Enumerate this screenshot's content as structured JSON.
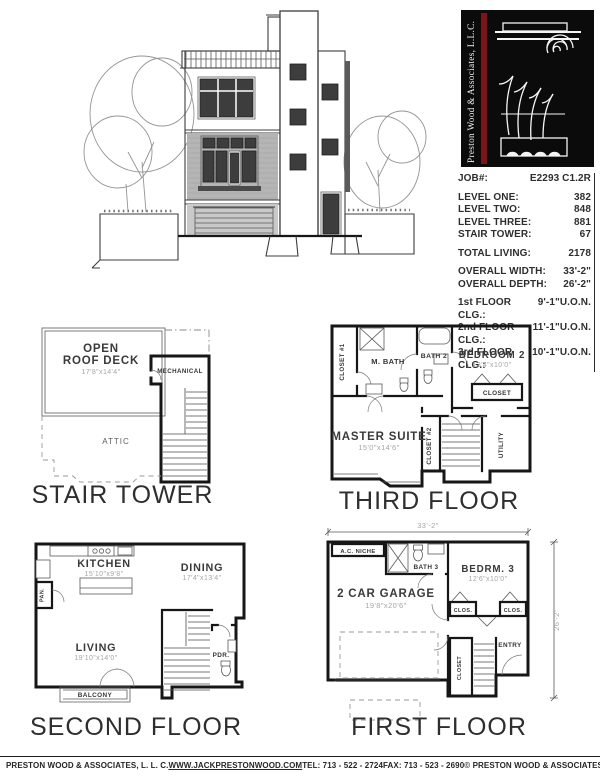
{
  "colors": {
    "line": "#161616",
    "logo_bg": "#0b0b0b",
    "logo_stripe": "#7d1418",
    "dim_text": "#a6a6a6"
  },
  "logo": {
    "vertical_text": "Preston Wood & Associates, L.L.C."
  },
  "info": {
    "job": {
      "label": "JOB#:",
      "value": "E2293 C1.2R"
    },
    "levels": [
      {
        "label": "LEVEL ONE:",
        "value": "382"
      },
      {
        "label": "LEVEL TWO:",
        "value": "848"
      },
      {
        "label": "LEVEL THREE:",
        "value": "881"
      },
      {
        "label": "STAIR TOWER:",
        "value": "67"
      }
    ],
    "total": {
      "label": "TOTAL LIVING:",
      "value": "2178"
    },
    "overall": [
      {
        "label": "OVERALL WIDTH:",
        "value": "33'-2\""
      },
      {
        "label": "OVERALL DEPTH:",
        "value": "26'-2\""
      }
    ],
    "ceilings": [
      {
        "label": "1st FLOOR CLG.:",
        "value": "9'-1\"U.O.N."
      },
      {
        "label": "2nd FLOOR CLG.:",
        "value": "11'-1\"U.O.N."
      },
      {
        "label": "3rd FLOOR CLG.:",
        "value": "10'-1\"U.O.N."
      }
    ]
  },
  "plans": {
    "stair_tower": {
      "title": "STAIR TOWER",
      "open_line1": "OPEN",
      "open_line2": "ROOF DECK",
      "open_dim": "17'8\"x14'4\"",
      "mechanical": "MECHANICAL",
      "attic": "ATTIC"
    },
    "third_floor": {
      "title": "THIRD FLOOR",
      "closet1": "CLOSET #1",
      "mbath": "M. BATH",
      "bath2": "BATH 2",
      "bedroom2": "BEDROOM 2",
      "bedroom2_dim": "13'4\"x10'0\"",
      "closet": "CLOSET",
      "master": "MASTER SUITE",
      "master_dim": "15'0\"x14'6\"",
      "closet2": "CLOSET #2",
      "utility": "UTILITY"
    },
    "second_floor": {
      "title": "SECOND FLOOR",
      "kitchen": "KITCHEN",
      "kitchen_dim": "15'10\"x9'8\"",
      "dining": "DINING",
      "dining_dim": "17'4\"x13'4\"",
      "living": "LIVING",
      "living_dim": "19'10\"x14'0\"",
      "pan": "PAN.",
      "pdr": "PDR.",
      "balcony": "BALCONY"
    },
    "first_floor": {
      "title": "FIRST FLOOR",
      "width_dim": "33'-2\"",
      "depth_dim": "26'-2\"",
      "ac_niche": "A.C. NICHE",
      "bath3": "BATH 3",
      "bedrm3": "BEDRM. 3",
      "bedrm3_dim": "12'6\"x10'0\"",
      "garage": "2 CAR GARAGE",
      "garage_dim": "19'8\"x20'6\"",
      "clos_left": "CLOS.",
      "clos_right": "CLOS.",
      "closet": "CLOSET",
      "entry": "ENTRY"
    }
  },
  "footer": {
    "company": "PRESTON WOOD & ASSOCIATES, L. L. C.",
    "website": "WWW.JACKPRESTONWOOD.COM",
    "tel": "TEL:  713 - 522 - 2724",
    "fax": "FAX:  713 - 523 - 2690",
    "copyright": "© PRESTON WOOD & ASSOCIATES, L. L. C.  COPYRIGHT"
  }
}
